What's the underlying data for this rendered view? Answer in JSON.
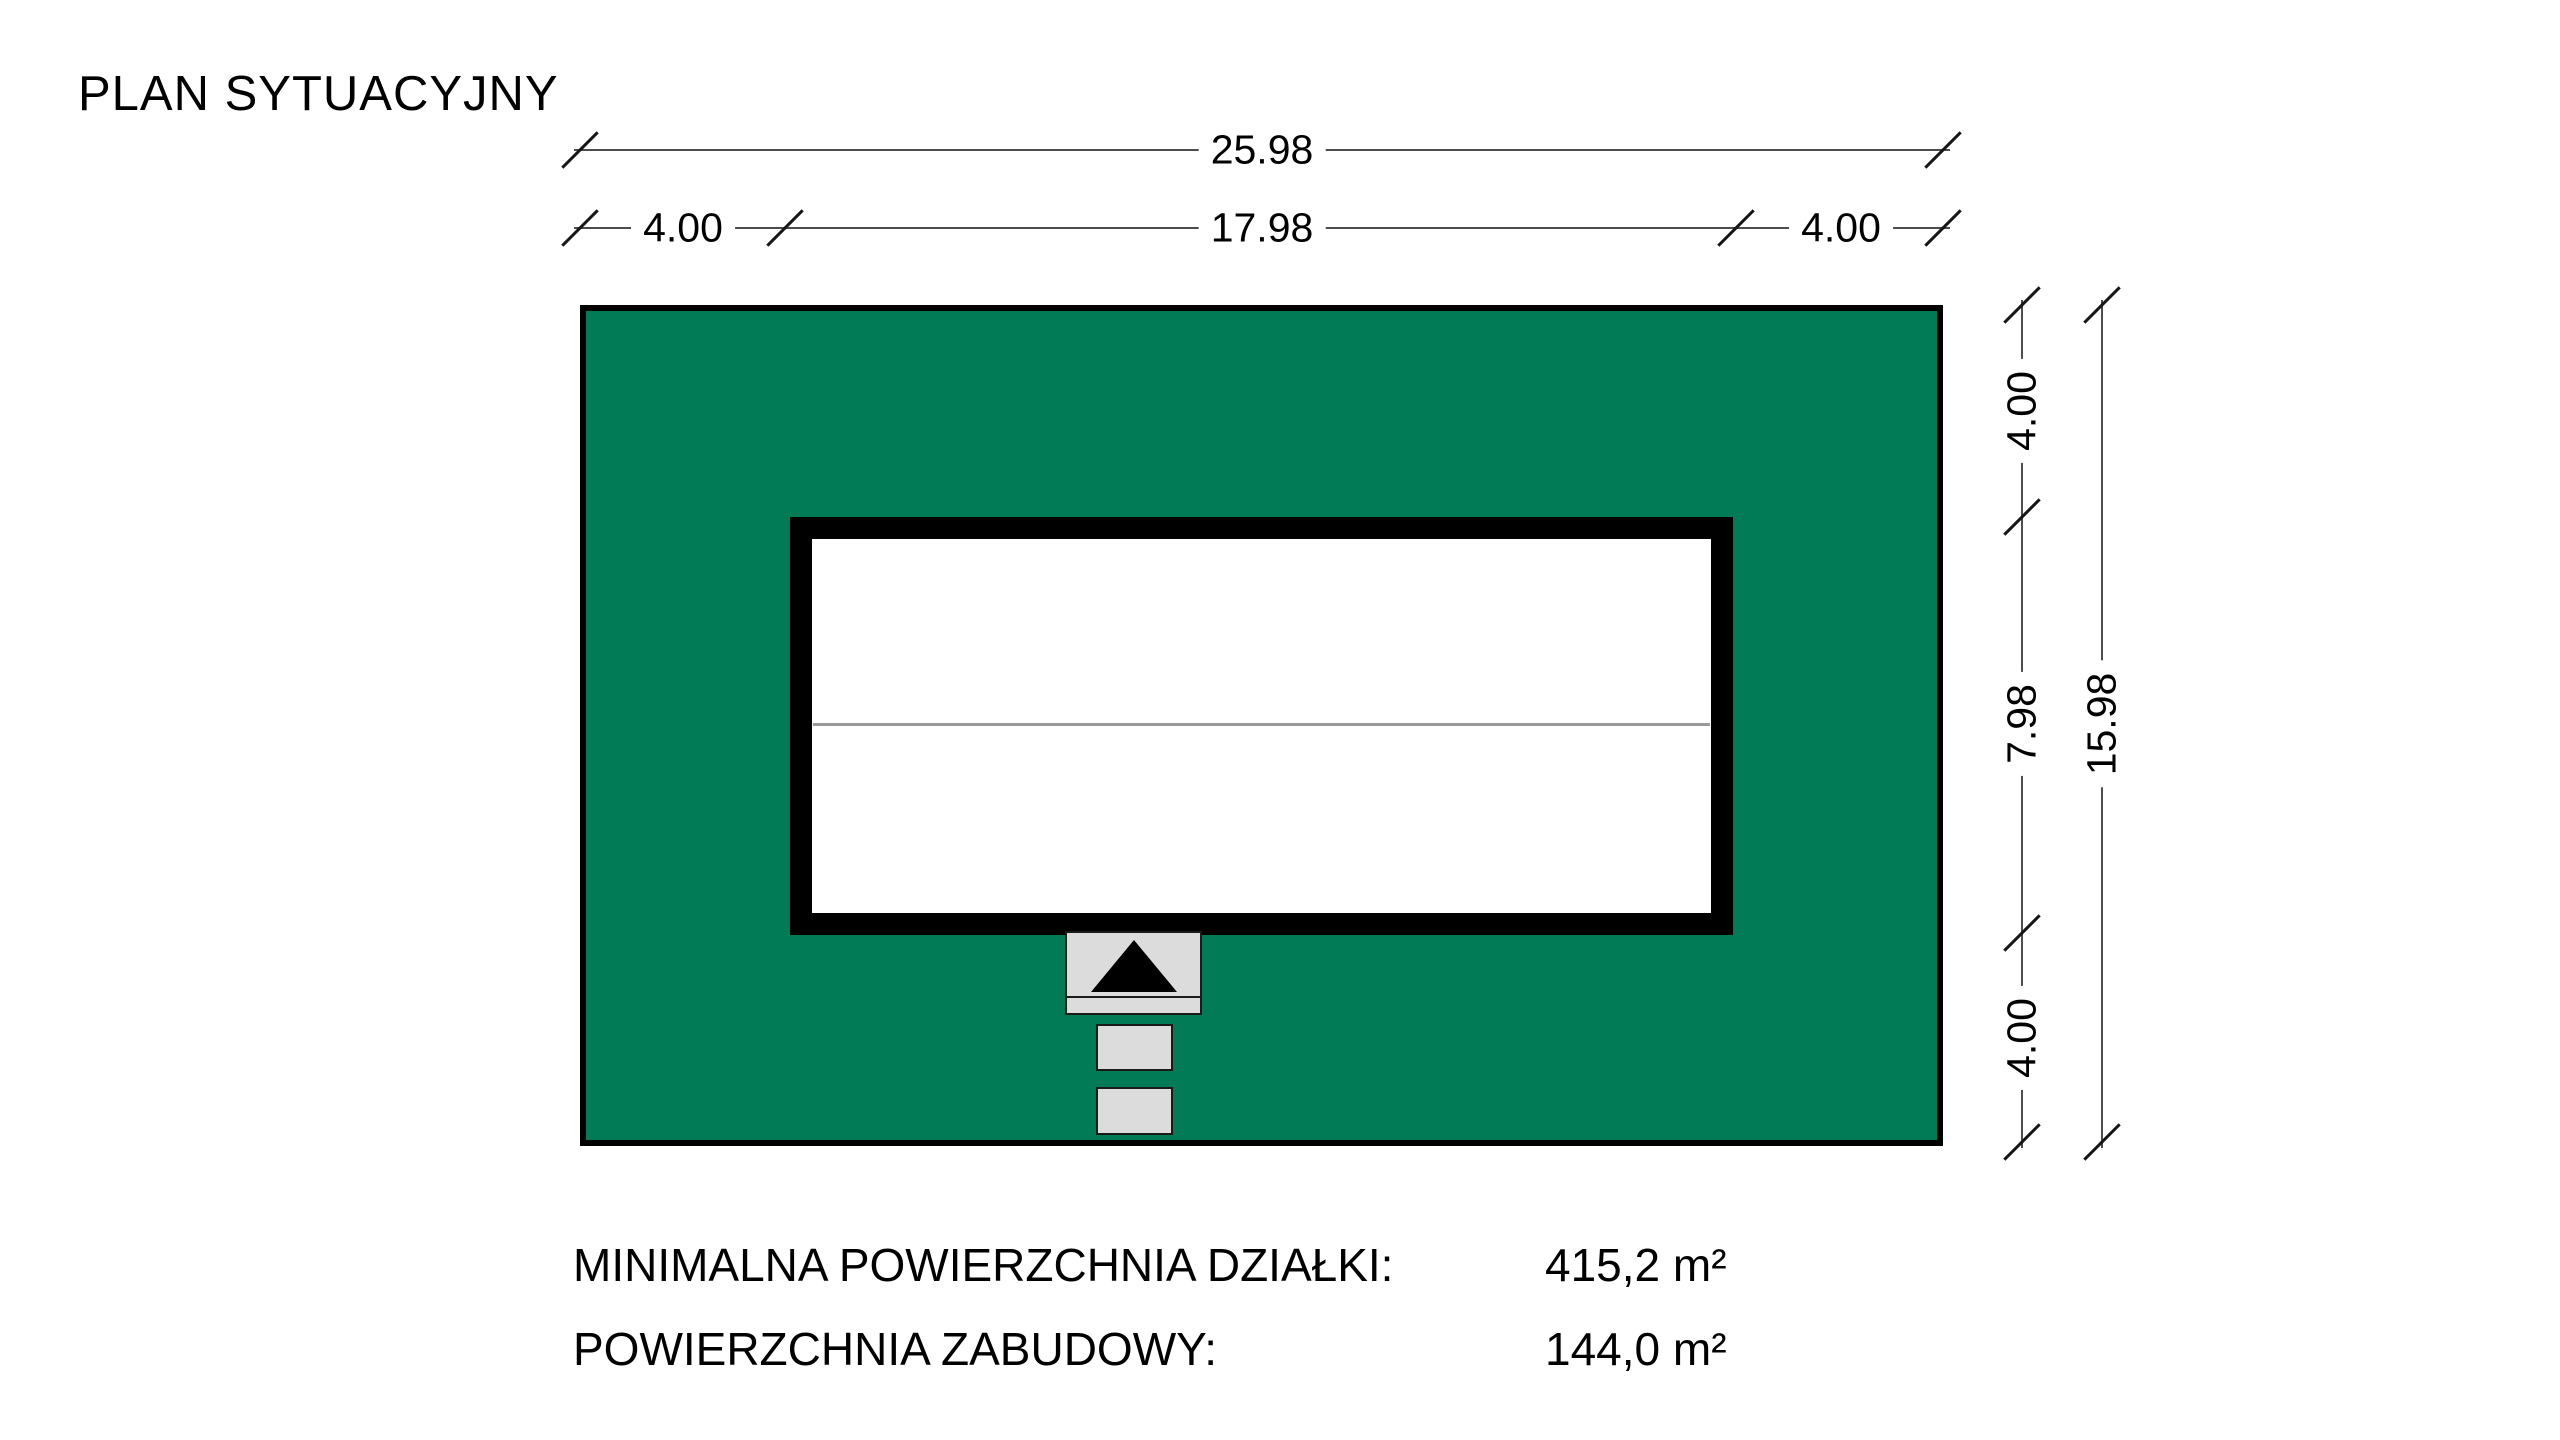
{
  "title": "PLAN SYTUACYJNY",
  "dimensions": {
    "top_total": "25.98",
    "top_left_setback": "4.00",
    "top_building_width": "17.98",
    "top_right_setback": "4.00",
    "right_top_setback": "4.00",
    "right_building_depth": "7.98",
    "right_bottom_setback": "4.00",
    "right_total": "15.98"
  },
  "areas": {
    "min_plot_label": "MINIMALNA POWIERZCHNIA DZIAŁKI:",
    "min_plot_value": "415,2 m²",
    "building_label": "POWIERZCHNIA ZABUDOWY:",
    "building_value": "144,0 m²"
  },
  "colors": {
    "plot_green": "#007B55",
    "entry_gray": "#DCDCDC",
    "outline_black": "#000000"
  }
}
